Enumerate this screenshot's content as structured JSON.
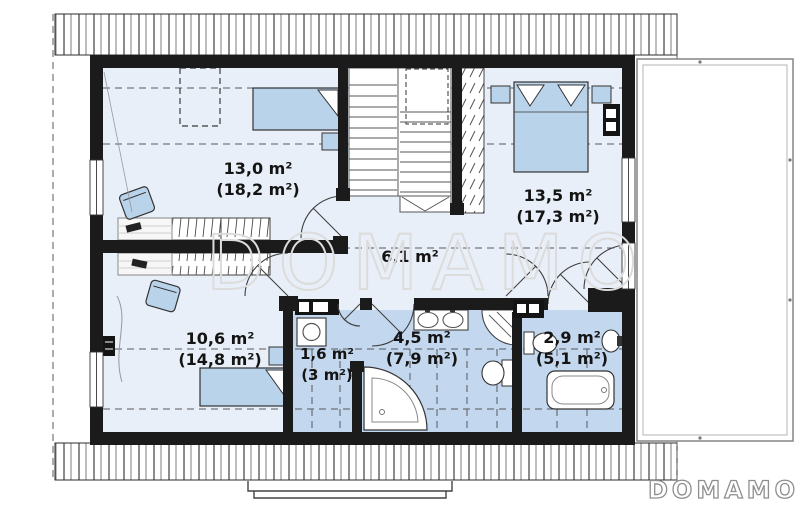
{
  "title": "attic-floor-plan",
  "watermark_text": "DOMAMO",
  "brand_logo_text": "DOMAMO",
  "rooms": [
    {
      "id": "room-top-left",
      "area": "13,0 m²",
      "attic_area": "(18,2 m²)"
    },
    {
      "id": "bedroom-top-right",
      "area": "13,5 m²",
      "attic_area": "(17,3 m²)"
    },
    {
      "id": "hall",
      "area": "6,1 m²",
      "attic_area": ""
    },
    {
      "id": "room-bottom-left",
      "area": "10,6 m²",
      "attic_area": "(14,8 m²)"
    },
    {
      "id": "laundry",
      "area": "1,6 m²",
      "attic_area": "(3 m²)"
    },
    {
      "id": "bathroom",
      "area": "4,5 m²",
      "attic_area": "(7,9 m²)"
    },
    {
      "id": "wc",
      "area": "2,9 m²",
      "attic_area": "(5,1 m²)"
    }
  ],
  "colors": {
    "wall": "#1b1b1b",
    "floor": "#e9eff8",
    "wet_floor": "#c3d7ee",
    "furniture": "#b9d3eb",
    "hatch_line": "#3a3a3a",
    "dashed_line": "#5a5a5a",
    "watermark": "#dcdcdc",
    "logo_gray": "#8f8f8f"
  }
}
